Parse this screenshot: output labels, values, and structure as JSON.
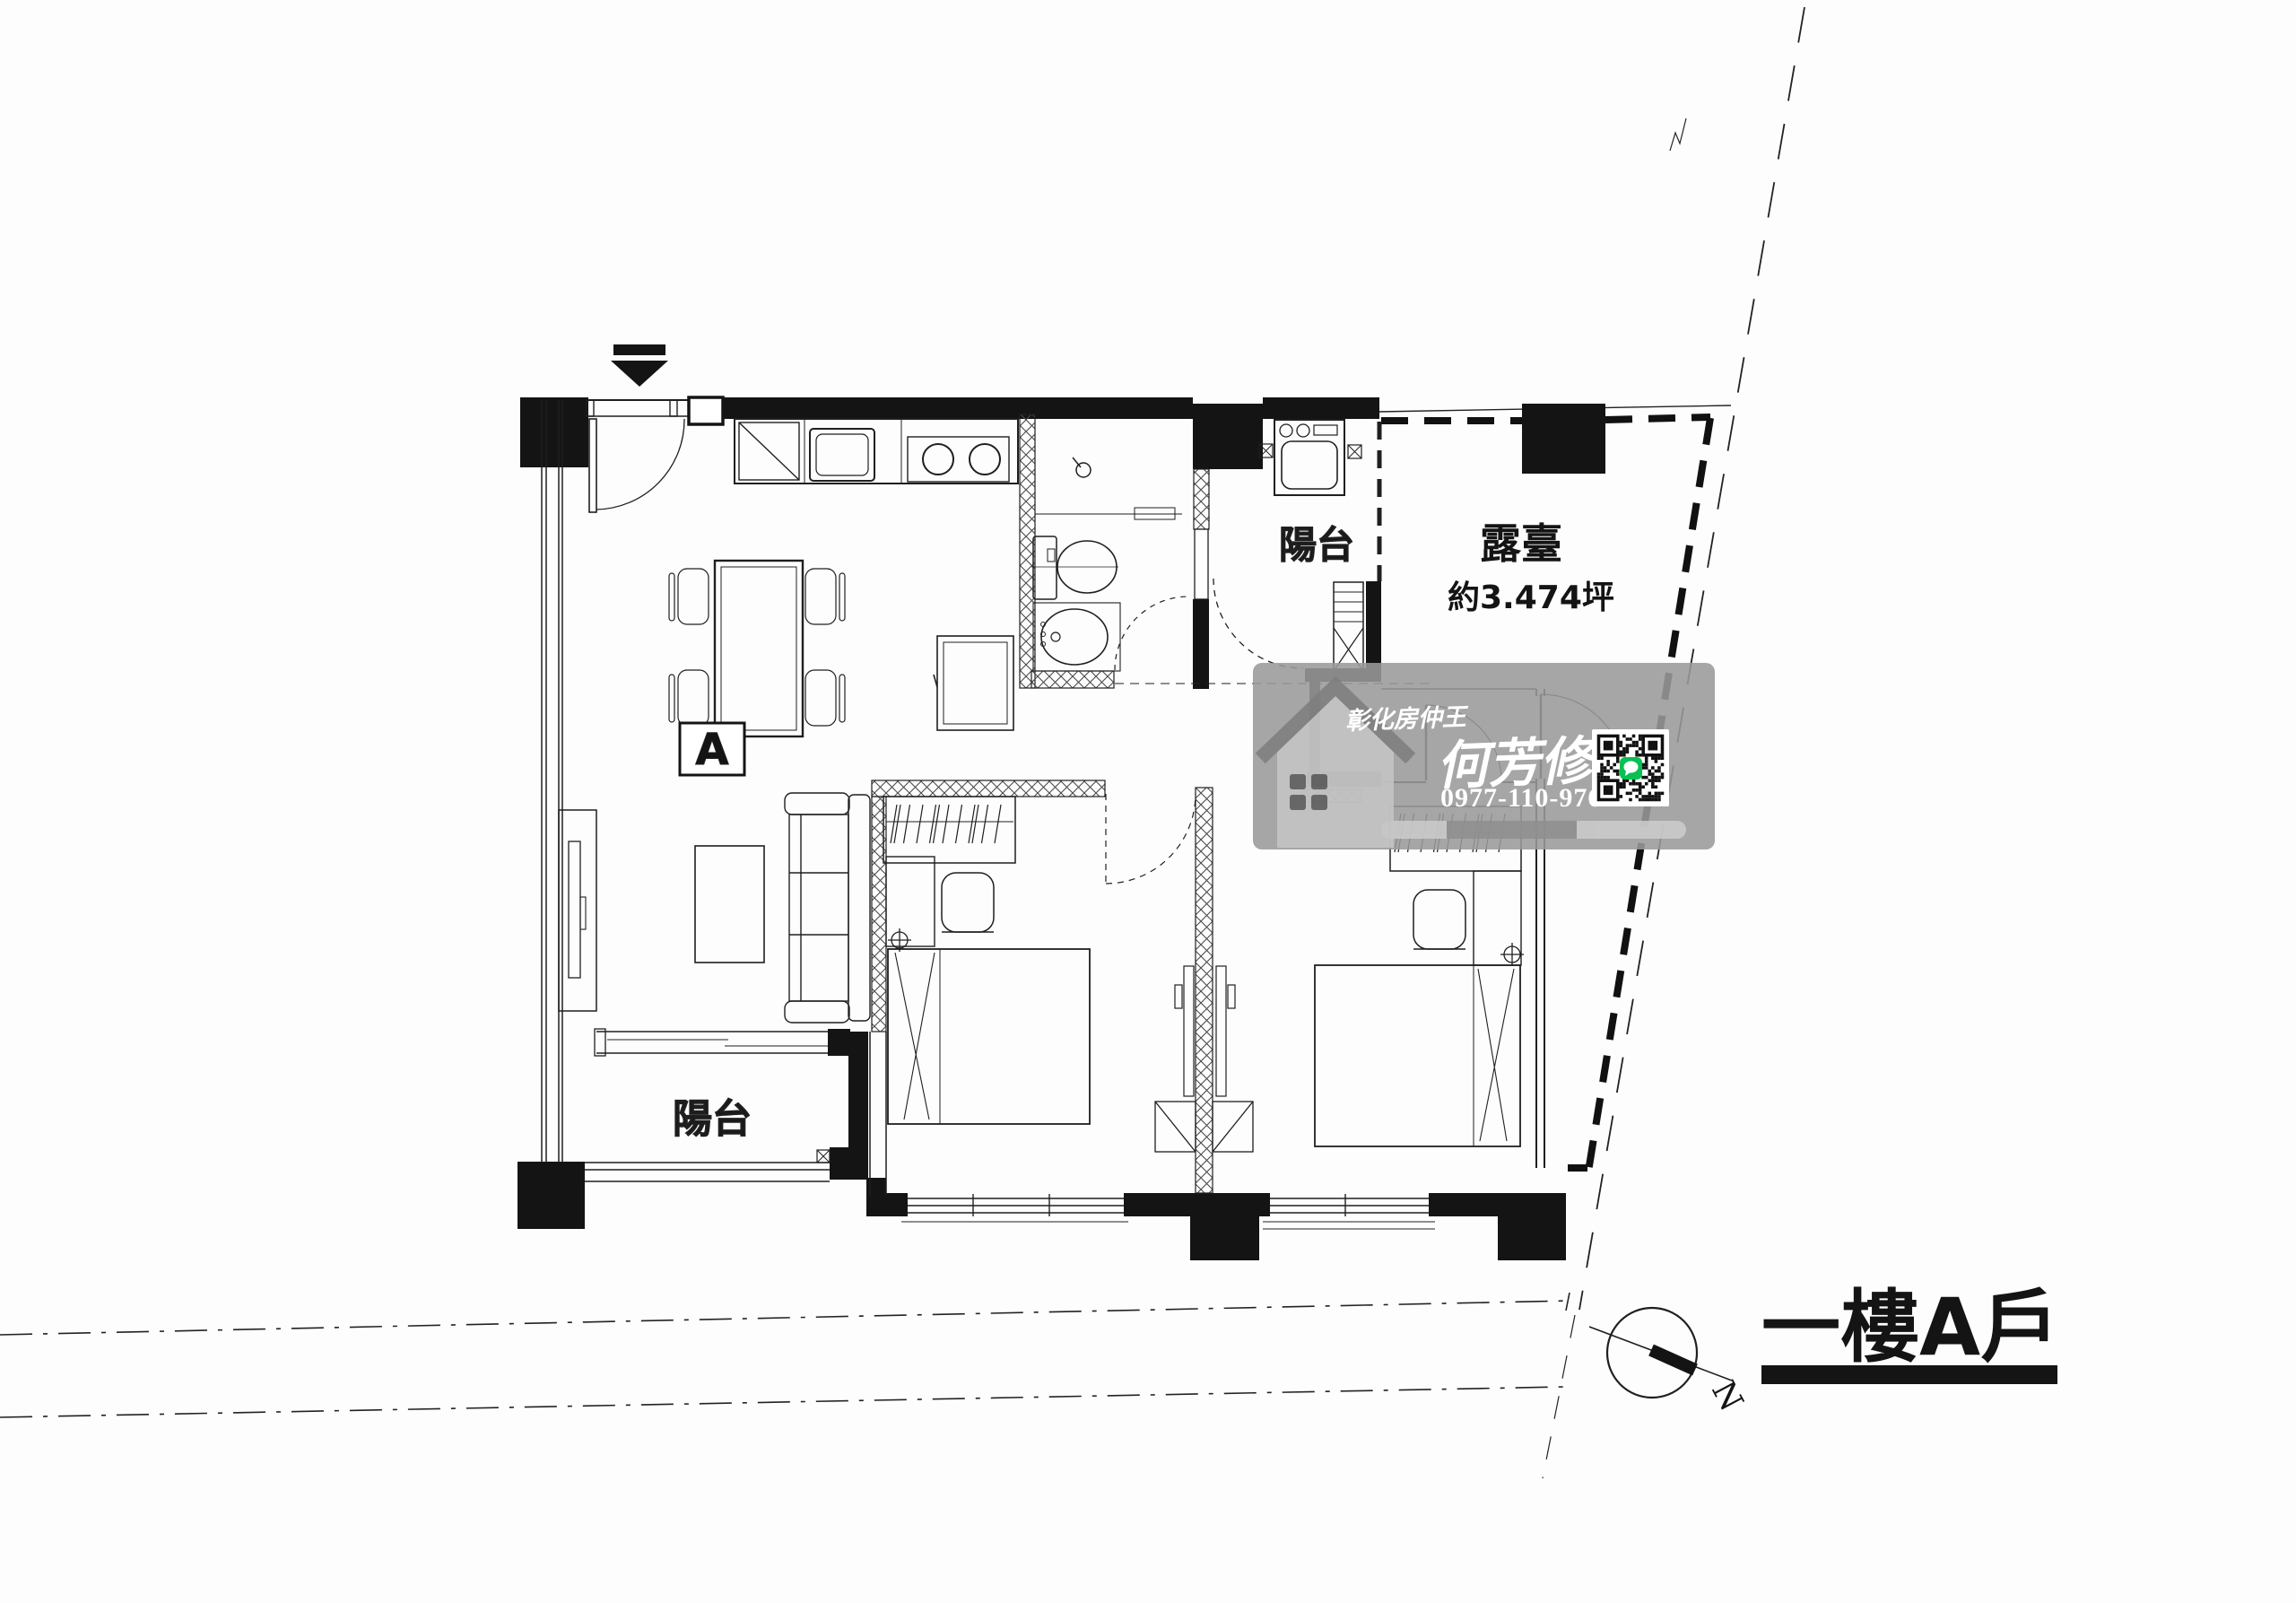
{
  "meta": {
    "kind": "scanned architectural floor plan",
    "floor_unit": "first floor unit A"
  },
  "labels": {
    "unit_marker": "A",
    "balcony_top": "陽台",
    "balcony_bottom": "陽台",
    "terrace": "露臺",
    "terrace_area": "約3.474坪"
  },
  "title": {
    "text": "一樓A戶"
  },
  "compass": {
    "north": "N"
  },
  "watermark": {
    "brand": "彰化房仲王",
    "agent": "何芳修",
    "phone": "0977-110-976",
    "qr": "line-qr-code"
  },
  "colors": {
    "ink": "#1f1f1f",
    "wall_fill": "#141414",
    "watermark_band": "#9a9a9a",
    "house_light": "#c6c6c6",
    "house_dark": "#5d5d5d",
    "line_green": "#06c152",
    "paper": "#fdfdfd"
  }
}
